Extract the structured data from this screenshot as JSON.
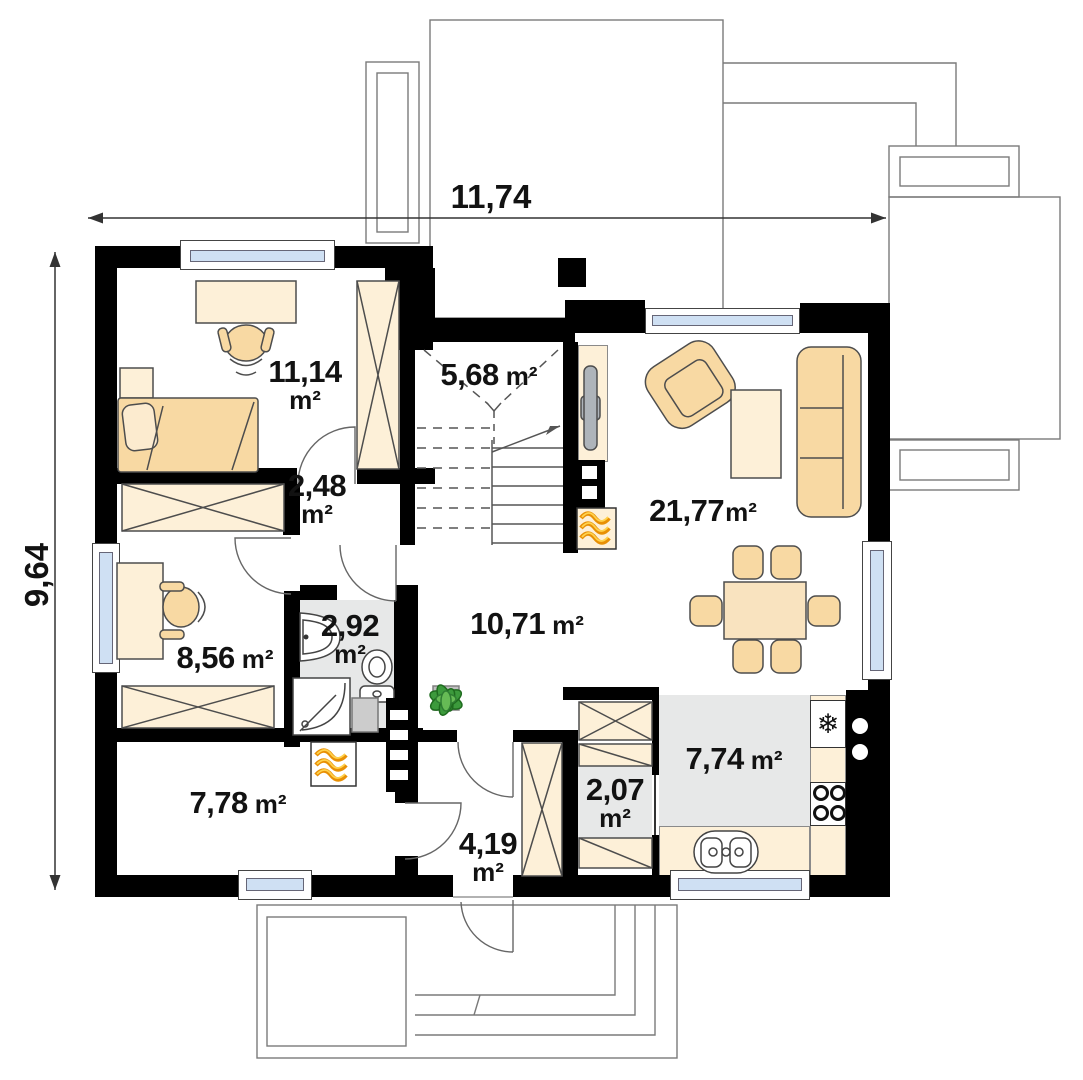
{
  "colors": {
    "wall": "#000000",
    "glass": "#cfe0f3",
    "tile": "#e7e8e8",
    "cream": "#fdf0d8",
    "peach": "#f8d9a3",
    "outline": "#7a7a7a",
    "flame": "#e89005",
    "flameHighlight": "#ffd24d",
    "plant": "#3c9a3c"
  },
  "dimensions": {
    "width": {
      "value": "11,74"
    },
    "height": {
      "value": "9,64"
    }
  },
  "rooms": [
    {
      "name": "bedroom",
      "value": "11,14",
      "unit": "m²"
    },
    {
      "name": "staircase",
      "value": "5,68",
      "unit": "m²"
    },
    {
      "name": "upper-hall",
      "value": "2,48",
      "unit": "m²"
    },
    {
      "name": "living-room",
      "value": "21,77",
      "unit": "m²"
    },
    {
      "name": "office",
      "value": "8,56",
      "unit": "m²"
    },
    {
      "name": "bathroom",
      "value": "2,92",
      "unit": "m²"
    },
    {
      "name": "hall",
      "value": "10,71",
      "unit": "m²"
    },
    {
      "name": "utility-room",
      "value": "7,78",
      "unit": "m²"
    },
    {
      "name": "entry",
      "value": "4,19",
      "unit": "m²"
    },
    {
      "name": "pantry",
      "value": "2,07",
      "unit": "m²"
    },
    {
      "name": "kitchen",
      "value": "7,74",
      "unit": "m²"
    }
  ],
  "icons": {
    "fridge": "❄"
  }
}
